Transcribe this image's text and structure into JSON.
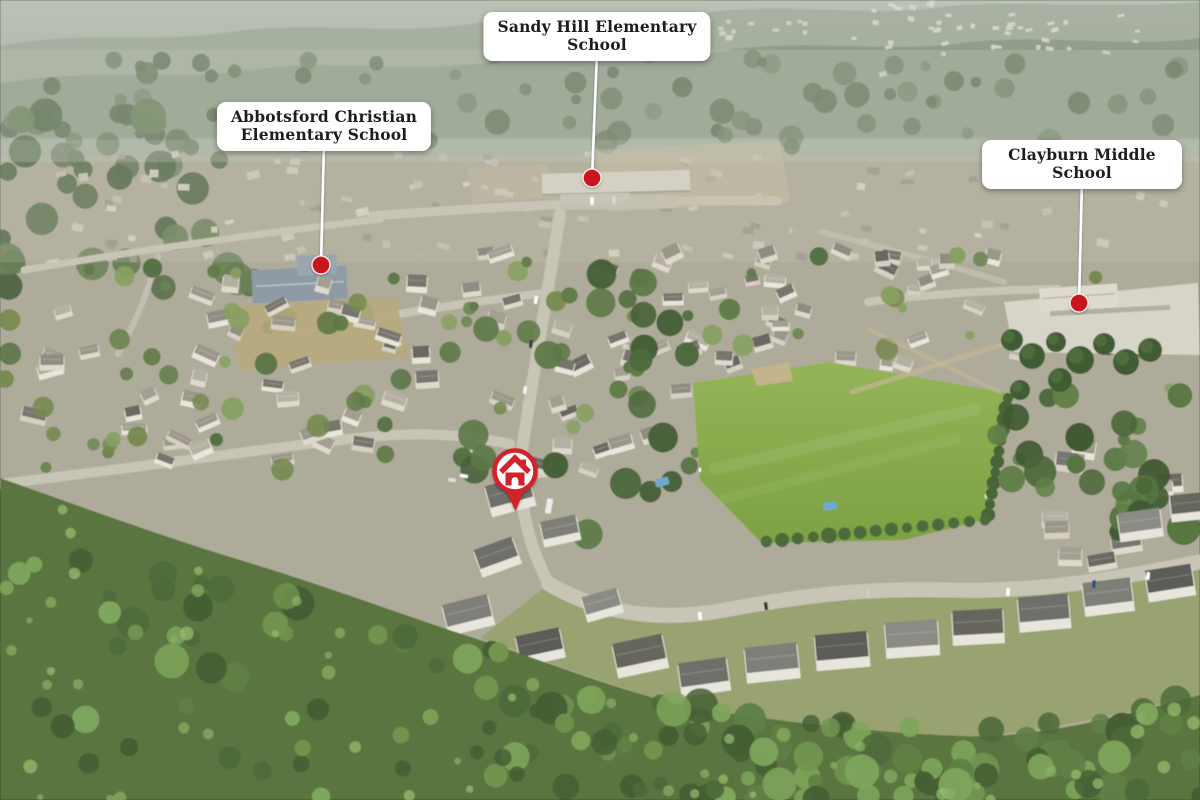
{
  "callouts": [
    {
      "id": "sandy-hill",
      "line1": "Sandy Hill Elementary",
      "line2": "School",
      "cx": 597,
      "top": 12,
      "dot": {
        "x": 592,
        "y": 178
      }
    },
    {
      "id": "abbotsford-christian",
      "line1": "Abbotsford Christian",
      "line2": "Elementary School",
      "cx": 324,
      "top": 102,
      "dot": {
        "x": 321,
        "y": 265
      }
    },
    {
      "id": "clayburn-middle",
      "line1": "Clayburn Middle",
      "line2": "School",
      "cx": 1082,
      "top": 140,
      "dot": {
        "x": 1079,
        "y": 303
      }
    }
  ],
  "home_marker": {
    "icon": "home-icon",
    "x": 515,
    "y": 471
  },
  "colors": {
    "accent_red": "#d2232a",
    "dot_red": "#c9191f",
    "label_bg": "#ffffff",
    "label_text": "#1d1d1d",
    "pointer_line": "#ffffff"
  }
}
